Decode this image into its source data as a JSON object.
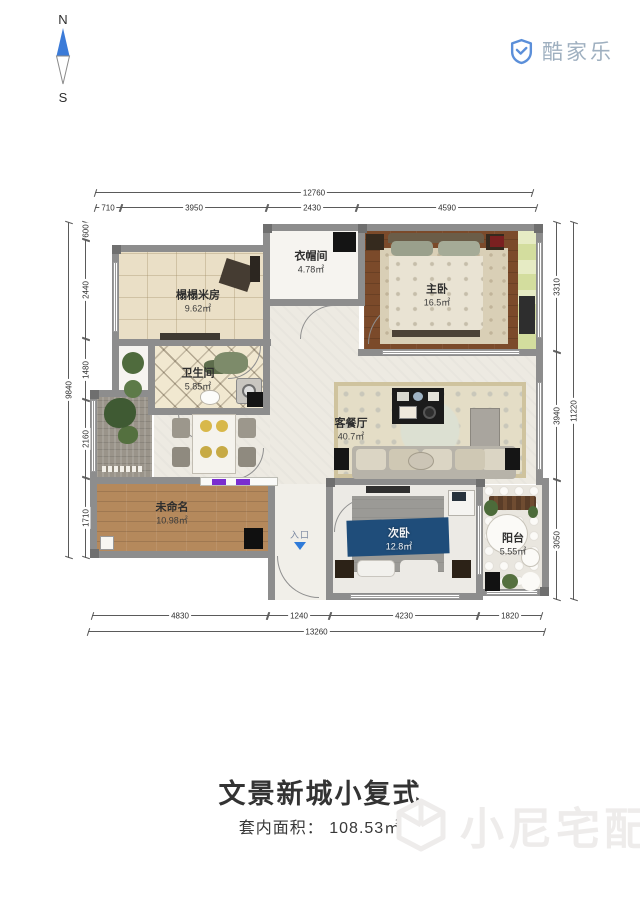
{
  "compass": {
    "north": "N",
    "south": "S"
  },
  "logo": {
    "brand": "酷家乐"
  },
  "rooms": {
    "tatami": {
      "name": "榻榻米房",
      "area": "9.62㎡"
    },
    "cloakroom": {
      "name": "衣帽间",
      "area": "4.78㎡"
    },
    "master": {
      "name": "主卧",
      "area": "16.5㎡"
    },
    "bathroom": {
      "name": "卫生间",
      "area": "5.85㎡"
    },
    "living": {
      "name": "客餐厅",
      "area": "40.7㎡"
    },
    "unnamed": {
      "name": "未命名",
      "area": "10.98㎡"
    },
    "second": {
      "name": "次卧",
      "area": "12.8㎡"
    },
    "balcony": {
      "name": "阳台",
      "area": "5.55㎡"
    }
  },
  "entrance": {
    "label": "入口"
  },
  "dims": {
    "top": {
      "total": "12760",
      "segments": [
        "710",
        "3950",
        "2430",
        "4590"
      ]
    },
    "bottom": {
      "total": "13260",
      "segments": [
        "4830",
        "1240",
        "4230",
        "1820"
      ]
    },
    "left": {
      "total": "9840",
      "segments": [
        "600",
        "2440",
        "1480",
        "2160",
        "1710"
      ]
    },
    "right": {
      "total": "11220",
      "segments": [
        "3310",
        "3940",
        "3050"
      ]
    }
  },
  "footer": {
    "title": "文景新城小复式",
    "area_label": "套内面积：  108.53㎡"
  },
  "watermark": {
    "text": "小尼宅配"
  },
  "colors": {
    "wall_gray": "#8d8d8d",
    "logo_blue": "#5b8fd9",
    "compass_blue": "#3b7bd8",
    "entrance_blue": "#2f7bd9",
    "wood_dark": "#7b4a2a",
    "wood_light": "#b5895c",
    "tatami_beige": "#eadfc6",
    "second_bed_blue": "#1f4d7a",
    "watermark_gray": "#eeeceb"
  }
}
